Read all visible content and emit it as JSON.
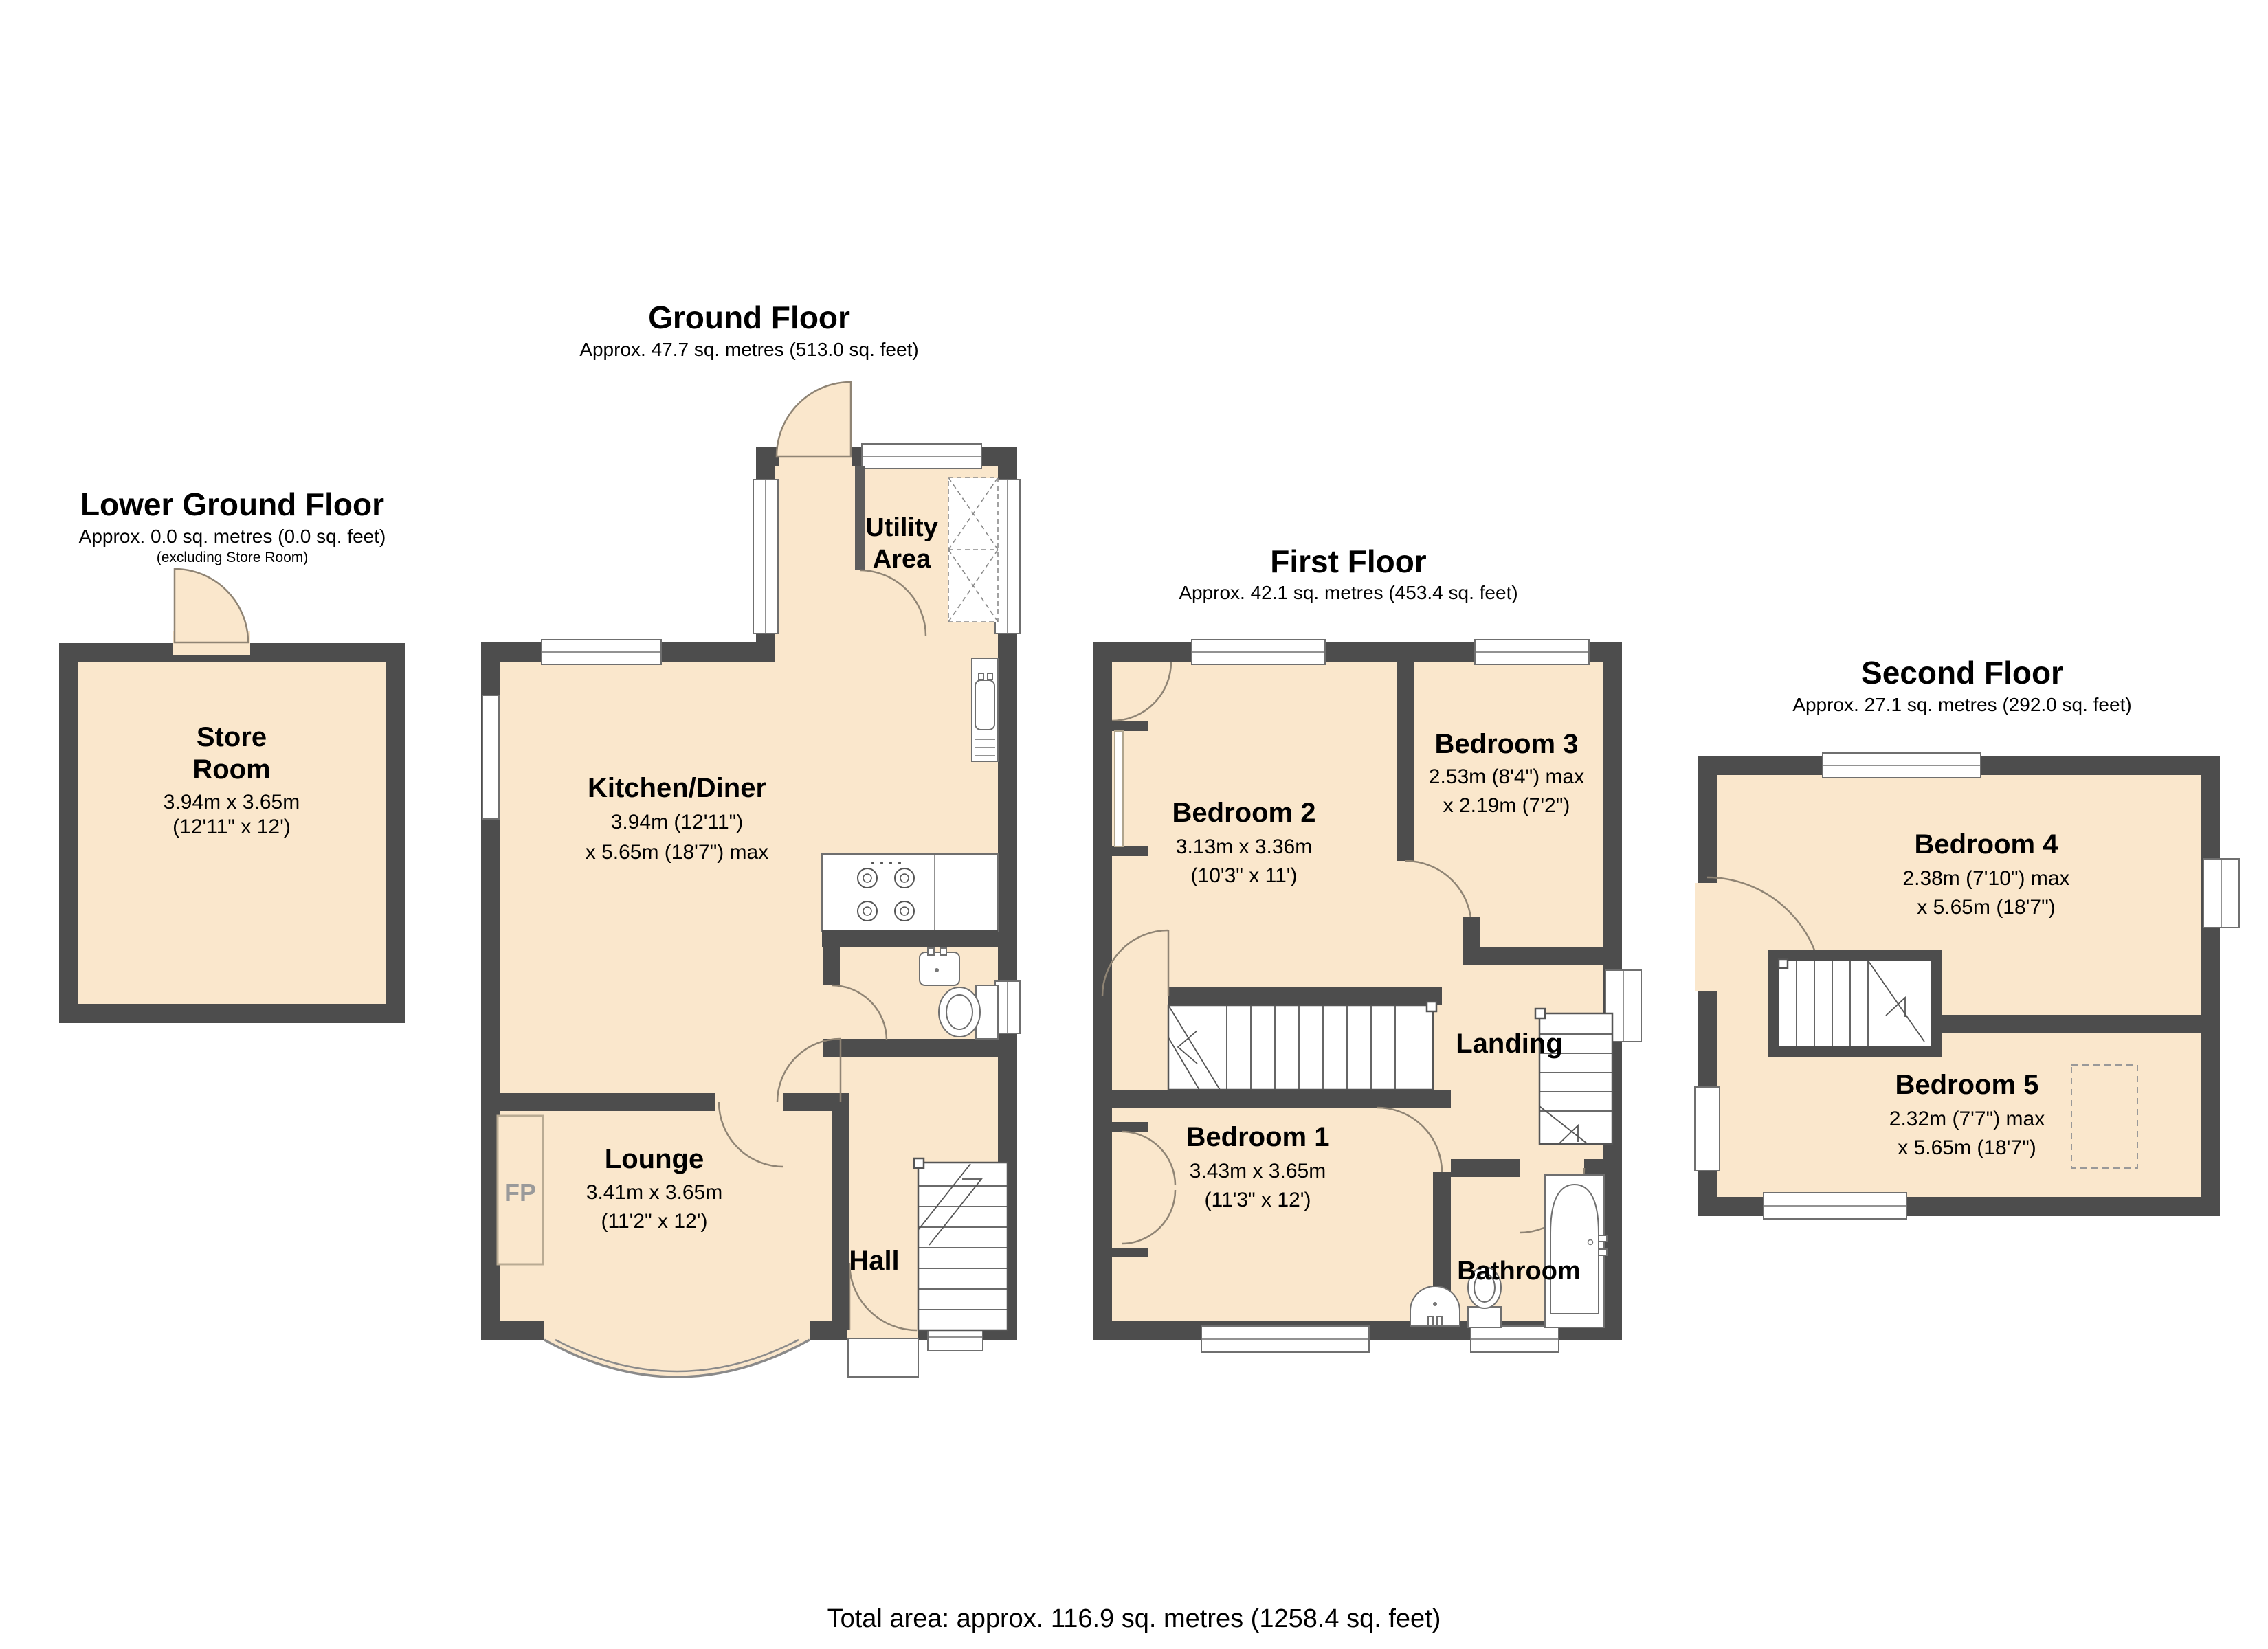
{
  "colors": {
    "wall": "#4d4d4d",
    "room_fill": "#fae7cc",
    "door_arc": "#8f8474",
    "background": "#ffffff"
  },
  "footer": {
    "total_area": "Total area: approx. 116.9 sq. metres (1258.4 sq. feet)"
  },
  "floors": {
    "lower_ground": {
      "title": "Lower Ground Floor",
      "area": "Approx. 0.0 sq. metres (0.0 sq. feet)",
      "note": "(excluding Store Room)",
      "rooms": {
        "store_room": {
          "line1": "Store",
          "line2": "Room",
          "dims_m": "3.94m x 3.65m",
          "dims_ft": "(12'11\" x 12')"
        }
      }
    },
    "ground": {
      "title": "Ground Floor",
      "area": "Approx. 47.7 sq. metres (513.0 sq. feet)",
      "rooms": {
        "utility": {
          "line1": "Utility",
          "line2": "Area"
        },
        "kitchen_diner": {
          "name": "Kitchen/Diner",
          "dims_m": "3.94m (12'11\")",
          "dims_ft": "x 5.65m (18'7\") max"
        },
        "lounge": {
          "name": "Lounge",
          "dims_m": "3.41m x 3.65m",
          "dims_ft": "(11'2\" x 12')"
        },
        "hall": {
          "name": "Hall"
        },
        "fireplace": {
          "label": "FP"
        }
      }
    },
    "first": {
      "title": "First Floor",
      "area": "Approx. 42.1 sq. metres (453.4 sq. feet)",
      "rooms": {
        "bedroom2": {
          "name": "Bedroom 2",
          "dims_m": "3.13m x 3.36m",
          "dims_ft": "(10'3\" x 11')"
        },
        "bedroom3": {
          "name": "Bedroom 3",
          "dims_m": "2.53m (8'4\") max",
          "dims_ft": "x 2.19m (7'2\")"
        },
        "bedroom1": {
          "name": "Bedroom 1",
          "dims_m": "3.43m x 3.65m",
          "dims_ft": "(11'3\" x 12')"
        },
        "landing": {
          "name": "Landing"
        },
        "bathroom": {
          "name": "Bathroom"
        }
      }
    },
    "second": {
      "title": "Second Floor",
      "area": "Approx. 27.1 sq. metres (292.0 sq. feet)",
      "rooms": {
        "bedroom4": {
          "name": "Bedroom 4",
          "dims_m": "2.38m (7'10\") max",
          "dims_ft": "x 5.65m (18'7\")"
        },
        "bedroom5": {
          "name": "Bedroom 5",
          "dims_m": "2.32m (7'7\") max",
          "dims_ft": "x 5.65m (18'7\")"
        }
      }
    }
  }
}
